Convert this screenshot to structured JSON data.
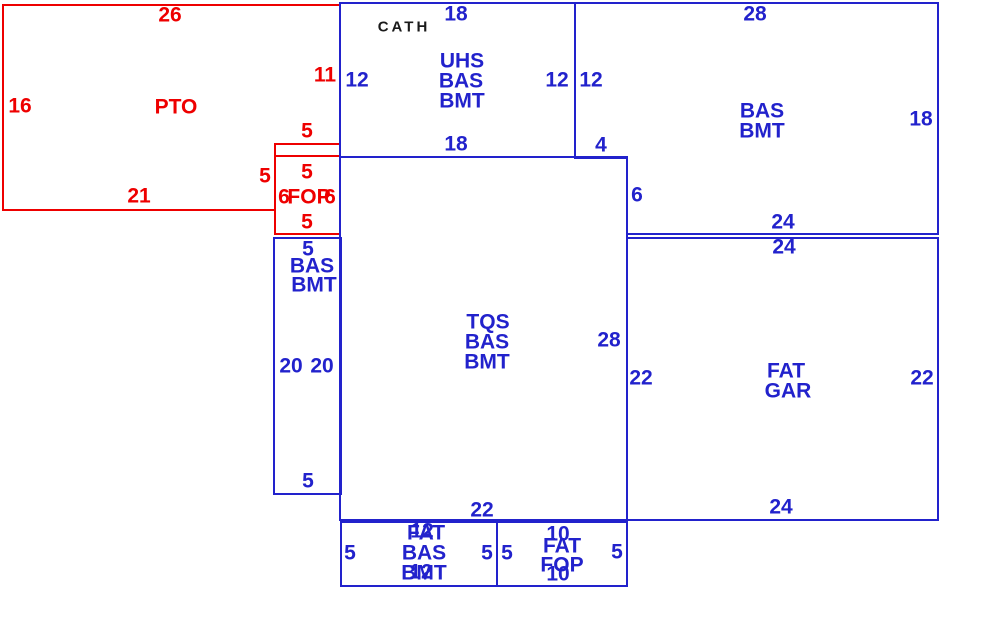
{
  "colors": {
    "red": "#ee0000",
    "blue": "#2222cc",
    "black": "#1a1a1a",
    "background": "#ffffff"
  },
  "areas": {
    "pto": {
      "label": "PTO",
      "dim_top": "26",
      "dim_left": "16",
      "dim_bottom": "21",
      "dim_right": "11",
      "dim_step_top": "5",
      "dim_step_left": "5"
    },
    "fop": {
      "label": "FOP",
      "dim_top": "5",
      "dim_left": "6",
      "dim_right": "6",
      "dim_bottom": "5"
    },
    "uhs": {
      "note": "CATH",
      "line1": "UHS",
      "line2": "BAS",
      "line3": "BMT",
      "dim_top": "18",
      "dim_left": "12",
      "dim_right": "12",
      "dim_bottom": "18"
    },
    "bas_bmt_ne": {
      "line1": "BAS",
      "line2": "BMT",
      "dim_top": "28",
      "dim_left": "12",
      "dim_right": "18",
      "dim_notch_h": "4",
      "dim_notch_v": "6",
      "dim_bottom": "24"
    },
    "tqs": {
      "line1": "TQS",
      "line2": "BAS",
      "line3": "BMT",
      "dim_right": "28",
      "dim_bottom": "22"
    },
    "bas_bmt_w": {
      "line1": "BAS",
      "line2": "BMT",
      "dim_top": "5",
      "dim_left": "20",
      "dim_right": "20",
      "dim_bottom": "5"
    },
    "fat_gar": {
      "line1": "FAT",
      "line2": "GAR",
      "dim_top": "24",
      "dim_left": "22",
      "dim_right": "22",
      "dim_bottom": "24"
    },
    "fat_bas_bmt": {
      "line1": "FAT",
      "line2": "BAS",
      "line3": "BMT",
      "dim_top": "12",
      "dim_left": "5",
      "dim_right": "5",
      "dim_bottom": "12"
    },
    "fat_fop": {
      "line1": "FAT",
      "line2": "FOP",
      "dim_top": "10",
      "dim_left": "5",
      "dim_right": "5",
      "dim_bottom": "10"
    }
  }
}
